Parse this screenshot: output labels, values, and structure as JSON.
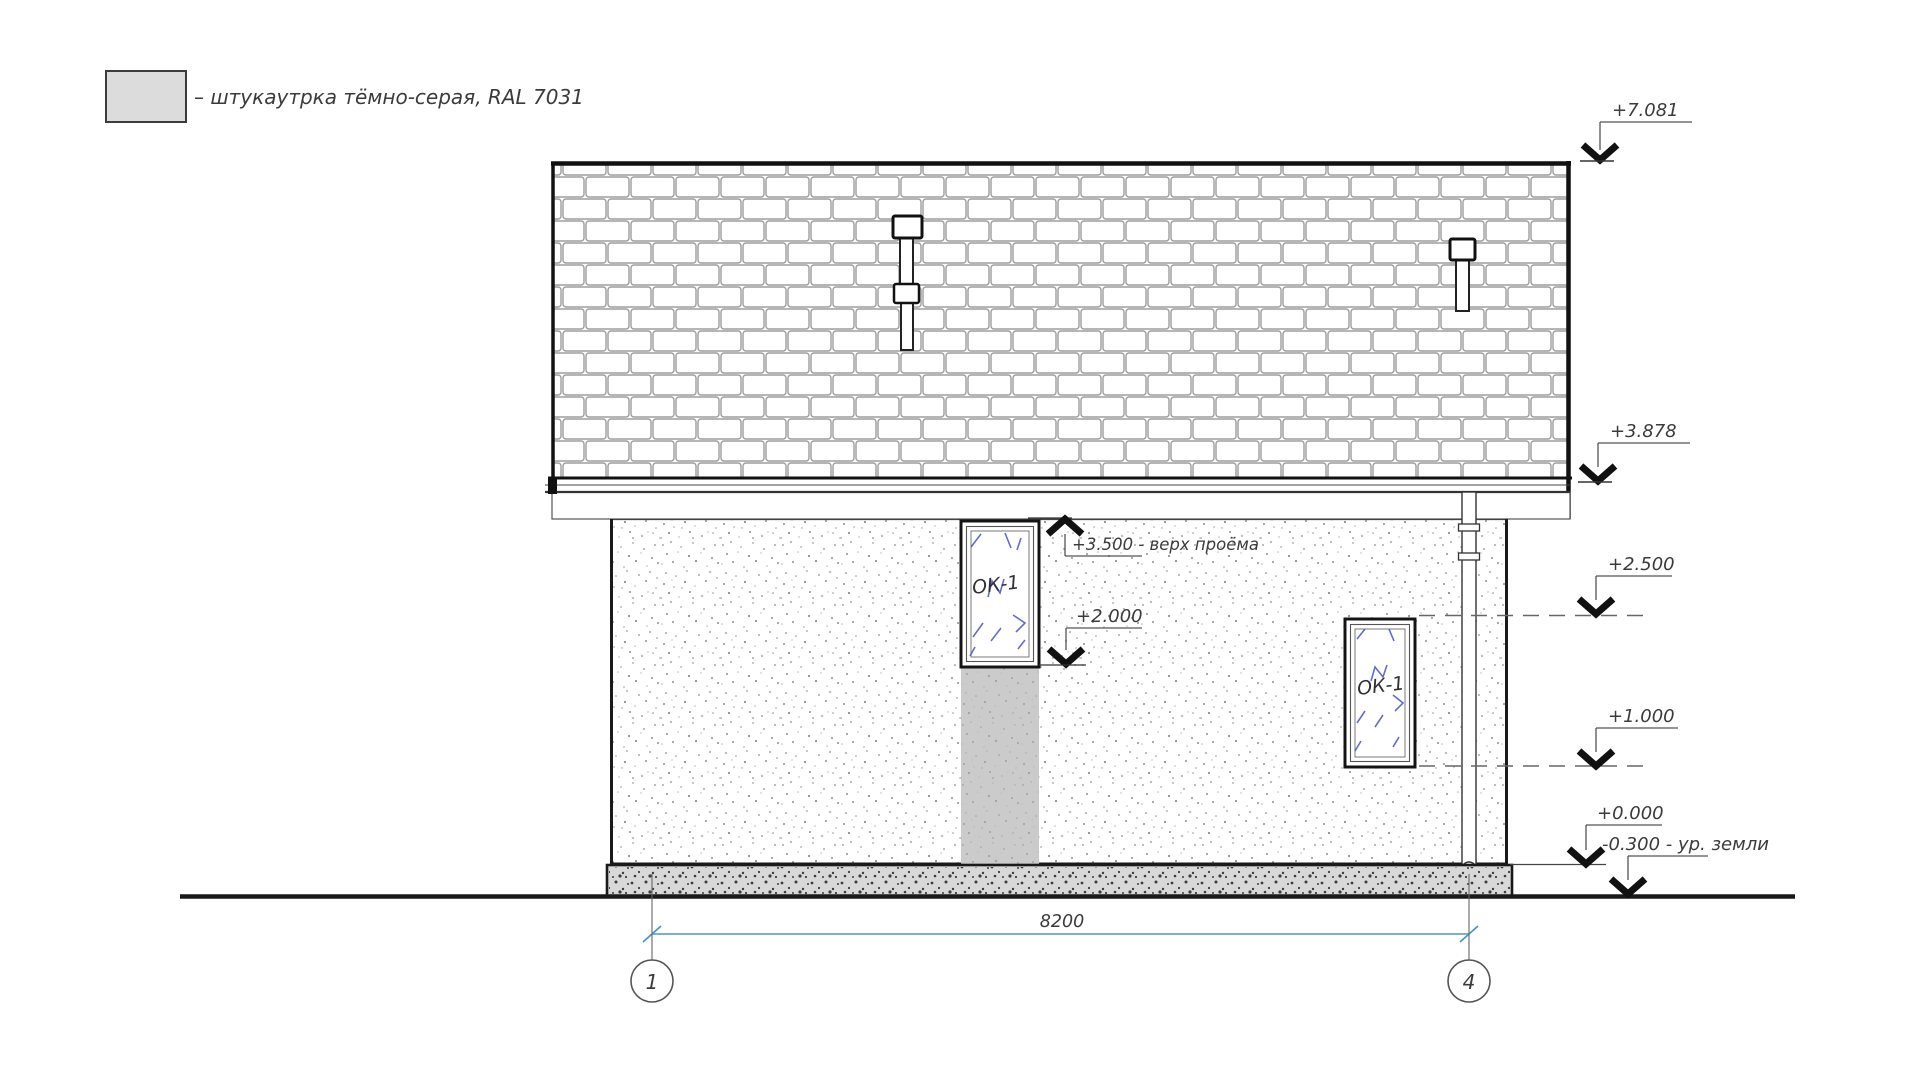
{
  "legend": {
    "swatch_color": "#dcdcdc",
    "label": "– штукаутрка тёмно-серая, RAL 7031"
  },
  "levels": {
    "right": [
      {
        "label": "+7.081"
      },
      {
        "label": "+3.878"
      },
      {
        "label": "+2.500"
      },
      {
        "label": "+1.000"
      },
      {
        "label": "+0.000"
      },
      {
        "label": "-0.300 - ур. земли"
      }
    ],
    "opening": [
      {
        "label": "+3.500 - верх проёма"
      },
      {
        "label": "+2.000"
      }
    ]
  },
  "windows": [
    {
      "label": "ОК-1"
    },
    {
      "label": "ОК-1"
    }
  ],
  "dimension": {
    "value": "8200",
    "color": "#4f97c2"
  },
  "axes": [
    {
      "label": "1"
    },
    {
      "label": "4"
    }
  ]
}
